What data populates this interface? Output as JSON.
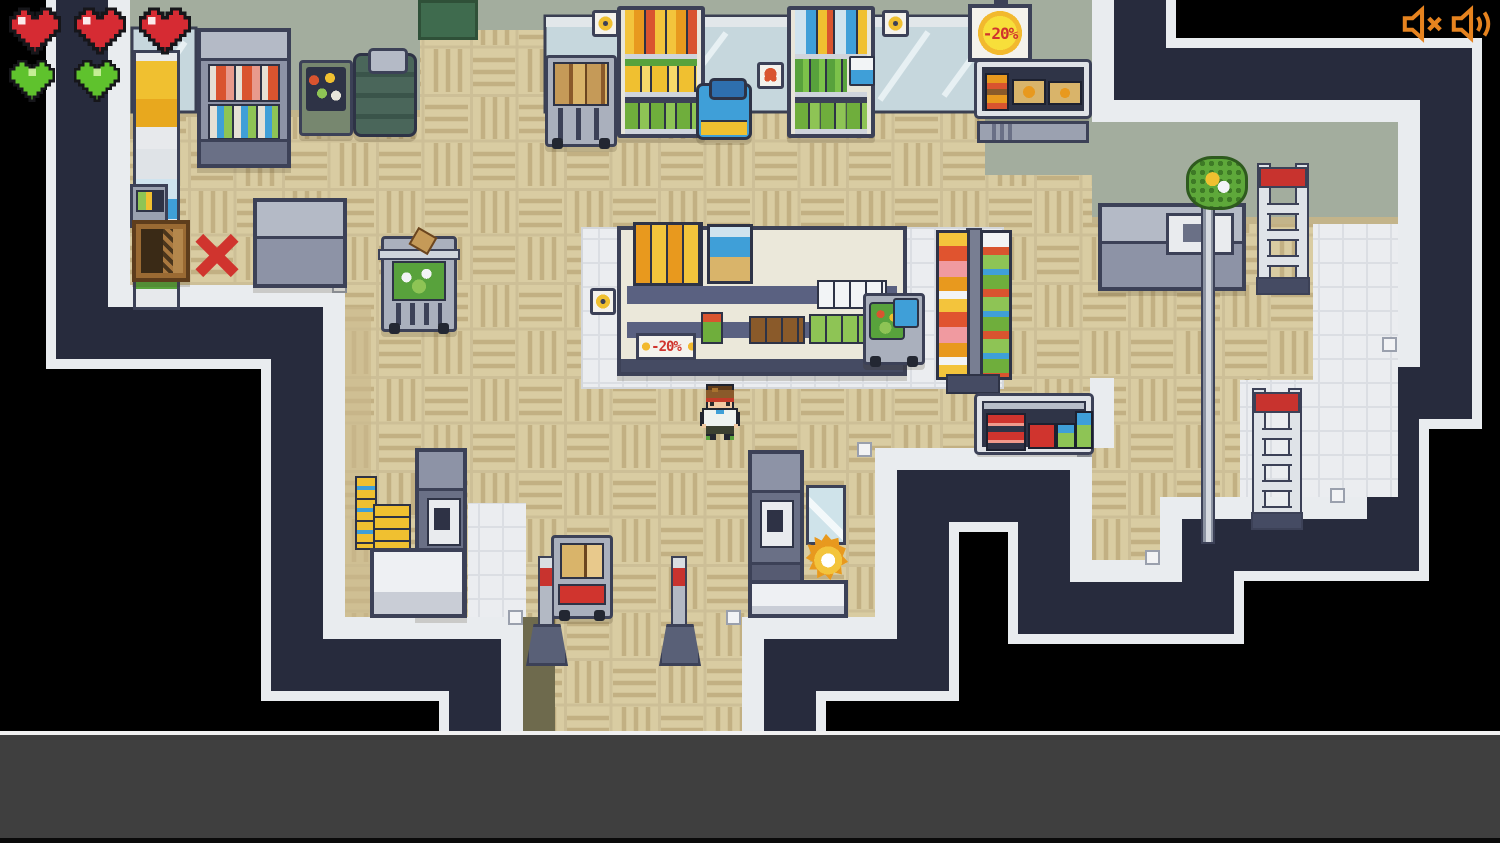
{
  "hud": {
    "health_hearts": 3,
    "shield_hearts": 2
  },
  "audio_controls": {
    "mute_icon": "speaker-muted-icon",
    "volume_icon": "speaker-waves-icon",
    "icon_color": "#e6831f"
  },
  "signs": {
    "hanging_discount": "-20%",
    "shelf_discount": "-20%"
  },
  "palette": {
    "void": "#000000",
    "wall_gap_navy": "#272b3d",
    "wall_band_white": "#e9ecef",
    "floor_beige": "#d9cca2",
    "wall_face_green": "#a3ad9e",
    "tile_white": "#ebedf0",
    "discount_red": "#d0342e",
    "sun_yellow": "#f7df3a",
    "heart_red": "#d62b33",
    "heart_green": "#5fc22d",
    "entrance_olive": "#6e6a4d"
  },
  "scene": {
    "description": "top-down pixel-art supermarket interior",
    "fixtures": [
      "wall-window",
      "wall-shelf",
      "fridge-display",
      "produce-basket",
      "barrel-stack",
      "floor-mat",
      "info-kiosk",
      "wooden-crate",
      "blocked-x-marker",
      "chest-freezer",
      "stock-cart",
      "shelf-rack-cereal",
      "cooler-bag",
      "shelf-rack-drinks",
      "hazard-wall-sign",
      "crab-wall-sign",
      "hanging-discount-sign",
      "display-freezer",
      "center-island-shelf",
      "island-discount-sign",
      "produce-cart",
      "snack-tower-rack",
      "chest-display-freezer",
      "player-shopper",
      "lettuce-cart",
      "box-pallet",
      "checkout-terminal",
      "checkout-counter",
      "box-cart",
      "glass-display-case",
      "sparkle-item",
      "entrance-bollard",
      "service-counter",
      "sign-pole",
      "hanging-plant",
      "step-ladder"
    ]
  }
}
